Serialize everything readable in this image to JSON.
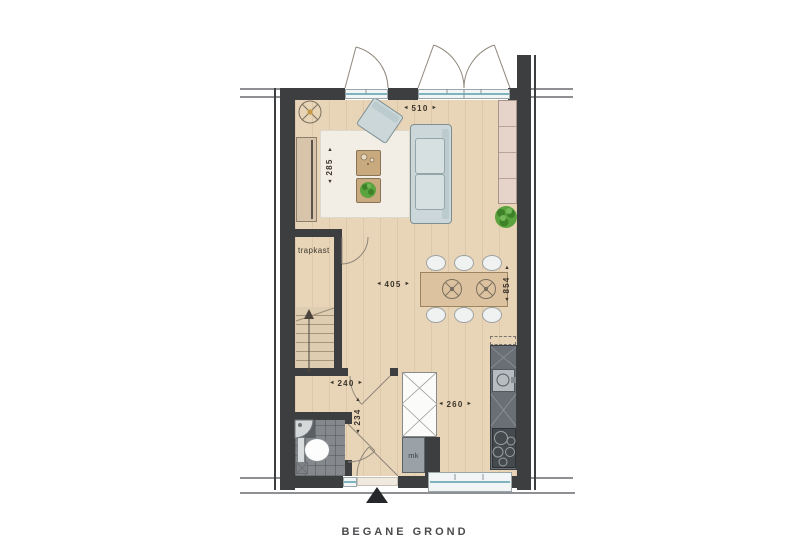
{
  "plan_title": "BEGANE GROND",
  "rooms": {
    "stair_closet_label": "trapkast",
    "meter_cupboard_label": "mk"
  },
  "dimensions_cm": {
    "living_width": "510",
    "living_depth": "285",
    "dining_width": "405",
    "interior_depth": "854",
    "hall_width": "240",
    "hall_depth": "234",
    "kitchen_width": "260"
  },
  "icons": {
    "arrow_left": "◄",
    "arrow_right": "►",
    "arrow_up": "▲",
    "arrow_down": "▼"
  },
  "colors": {
    "wall": "#3d3e40",
    "wood_floor": "#e8d4b6",
    "tile_floor": "#85898d",
    "glass": "#7fb3c0",
    "upholstery": "#cbd7d8",
    "annotation_text": "#3a342c",
    "plant": "#5aa33e"
  }
}
